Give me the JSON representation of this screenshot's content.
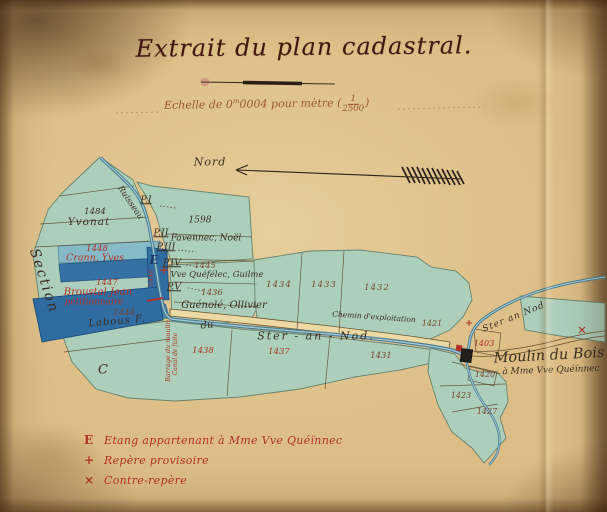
{
  "document": {
    "title": "Extrait du plan cadastral.",
    "scale_prefix": "Echelle de 0",
    "scale_sup": "m",
    "scale_rest": "0004 pour mètre",
    "scale_paren_open": "(",
    "scale_paren_close": ")",
    "scale_fraction_num": "1",
    "scale_fraction_den": "2500"
  },
  "colors": {
    "ink": "#3b2d20",
    "sepia": "#7a4630",
    "red": "#b23327",
    "navy": "#1b3a6b",
    "title_ink": "#431711",
    "scale_ink": "#9c5830",
    "paper": "#dcbd85",
    "map_wash": "#a8d0bf",
    "water_dark": "#2f6da3",
    "river_stroke": "#4a7d92",
    "road_fill": "#ecd9a4"
  },
  "legend": {
    "items": [
      {
        "symbol": "E",
        "symbol_name": "pond-letter-symbol",
        "text": "Etang appartenant à Mme Vve Quéïnnec"
      },
      {
        "symbol": "+",
        "symbol_name": "provisional-benchmark-symbol",
        "text": "Repère provisoire"
      },
      {
        "symbol": "×",
        "symbol_name": "counter-benchmark-symbol",
        "text": "Contre-repère"
      }
    ]
  },
  "map": {
    "labels": [
      {
        "text": "Nord",
        "x": 210,
        "y": 162,
        "size": 11,
        "color": "ink",
        "spacing": 1
      },
      {
        "text": "Section",
        "x": 44,
        "y": 281,
        "size": 14,
        "color": "ink",
        "rot": 72,
        "spacing": 2
      },
      {
        "text": "C",
        "x": 103,
        "y": 370,
        "size": 13,
        "color": "ink"
      },
      {
        "text": "Ruisseau",
        "x": 130,
        "y": 203,
        "size": 8.5,
        "color": "ink",
        "rot": 56
      },
      {
        "text": "P.I",
        "x": 146,
        "y": 200,
        "size": 9.5,
        "color": "ink",
        "underline": true
      },
      {
        "text": "1484",
        "x": 95,
        "y": 212,
        "size": 8.5,
        "color": "ink"
      },
      {
        "text": "Yvonat",
        "x": 89,
        "y": 222,
        "size": 10.5,
        "color": "ink",
        "spacing": 1
      },
      {
        "text": "1598",
        "x": 200,
        "y": 221,
        "size": 9,
        "color": "ink"
      },
      {
        "text": "P.II",
        "x": 161,
        "y": 233,
        "size": 9.5,
        "color": "ink",
        "underline": true
      },
      {
        "text": "Favennec, Noël",
        "x": 206,
        "y": 239,
        "size": 9,
        "color": "ink"
      },
      {
        "text": "1448",
        "x": 97,
        "y": 249,
        "size": 8.5,
        "color": "red"
      },
      {
        "text": "Crann, Yves",
        "x": 95,
        "y": 258,
        "size": 9.5,
        "color": "red"
      },
      {
        "text": "P.III",
        "x": 166,
        "y": 247,
        "size": 9.5,
        "color": "ink",
        "underline": true
      },
      {
        "text": "E",
        "x": 154,
        "y": 260,
        "size": 12,
        "color": "navy",
        "bold": true
      },
      {
        "text": "1446",
        "x": 151,
        "y": 278,
        "size": 6.5,
        "color": "red",
        "rot": -90
      },
      {
        "text": "P.IV",
        "x": 172,
        "y": 263,
        "size": 9.5,
        "color": "ink",
        "underline": true
      },
      {
        "text": "1445",
        "x": 205,
        "y": 266,
        "size": 8.5,
        "color": "sepia"
      },
      {
        "text": "Vve Quéfélec, Guilme",
        "x": 217,
        "y": 275,
        "size": 8.5,
        "color": "ink"
      },
      {
        "text": "P.V",
        "x": 174,
        "y": 287,
        "size": 9.5,
        "color": "ink",
        "underline": true
      },
      {
        "text": "1436",
        "x": 212,
        "y": 293,
        "size": 8.5,
        "color": "sepia"
      },
      {
        "text": "Guénolé, Ollivier",
        "x": 224,
        "y": 306,
        "size": 10,
        "color": "ink"
      },
      {
        "text": "1447",
        "x": 107,
        "y": 283,
        "size": 8.5,
        "color": "red"
      },
      {
        "text": "Broustal Jean",
        "x": 98,
        "y": 293,
        "size": 10,
        "color": "red"
      },
      {
        "text": "pétitionnaire",
        "x": 94,
        "y": 303,
        "size": 9,
        "color": "red"
      },
      {
        "text": "1444",
        "x": 124,
        "y": 313,
        "size": 8.5,
        "color": "sepia"
      },
      {
        "text": "Labous F.",
        "x": 117,
        "y": 322,
        "size": 10,
        "color": "ink",
        "rot": -5,
        "spacing": 1
      },
      {
        "text": "Barrage du moulin",
        "x": 168,
        "y": 351,
        "size": 6.5,
        "color": "red",
        "rot": -90
      },
      {
        "text": "Canal de fuite",
        "x": 176,
        "y": 354,
        "size": 6,
        "color": "red",
        "rot": -90
      },
      {
        "text": "1434",
        "x": 279,
        "y": 285,
        "size": 8.5,
        "color": "sepia",
        "spacing": 1
      },
      {
        "text": "1433",
        "x": 324,
        "y": 285,
        "size": 8.5,
        "color": "sepia",
        "spacing": 1
      },
      {
        "text": "1432",
        "x": 377,
        "y": 288,
        "size": 8.5,
        "color": "sepia",
        "spacing": 1
      },
      {
        "text": "Chemin d'exploitation",
        "x": 374,
        "y": 317,
        "size": 7.5,
        "color": "ink",
        "rot": 4
      },
      {
        "text": "1421",
        "x": 432,
        "y": 324,
        "size": 8,
        "color": "sepia"
      },
      {
        "text": "du",
        "x": 207,
        "y": 326,
        "size": 10,
        "color": "ink",
        "rot": -6
      },
      {
        "text": "Ster - an - Nod.",
        "x": 316,
        "y": 336,
        "size": 11,
        "color": "ink",
        "spacing": 2
      },
      {
        "text": "1438",
        "x": 203,
        "y": 351,
        "size": 8.5,
        "color": "red"
      },
      {
        "text": "1437",
        "x": 279,
        "y": 352,
        "size": 8.5,
        "color": "red"
      },
      {
        "text": "1431",
        "x": 381,
        "y": 356,
        "size": 8.5,
        "color": "sepia"
      },
      {
        "text": "Ster an Nod",
        "x": 514,
        "y": 318,
        "size": 9,
        "color": "ink",
        "rot": -22,
        "spacing": 1
      },
      {
        "text": "1403",
        "x": 484,
        "y": 344,
        "size": 8,
        "color": "red"
      },
      {
        "text": "Moulin du Bois",
        "x": 549,
        "y": 356,
        "size": 14.5,
        "color": "ink",
        "rot": -3
      },
      {
        "text": "à Mme Vve Quéïnnec",
        "x": 551,
        "y": 371,
        "size": 9,
        "color": "ink",
        "rot": -2
      },
      {
        "text": "1420",
        "x": 485,
        "y": 375,
        "size": 8,
        "color": "sepia"
      },
      {
        "text": "1423",
        "x": 461,
        "y": 396,
        "size": 8,
        "color": "sepia"
      },
      {
        "text": "1427",
        "x": 487,
        "y": 412,
        "size": 8,
        "color": "sepia"
      }
    ]
  }
}
